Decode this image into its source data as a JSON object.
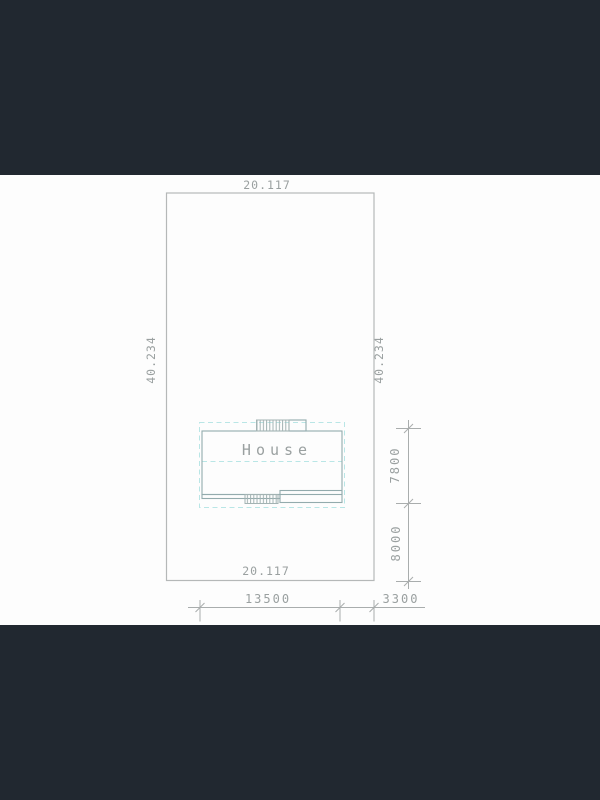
{
  "colors": {
    "band": "#212830",
    "paper": "#fdfdfd",
    "boundary": "#b5b8b8",
    "dims": "#a9adad",
    "house": "#93abad",
    "hatch": "#a3b3b3",
    "dashed": "#b9e6e6",
    "text": "#9aa0a0"
  },
  "plan": {
    "house_label": "House",
    "lot_width_top": "20.117",
    "lot_width_bottom": "20.117",
    "lot_depth_left": "40.234",
    "lot_depth_right": "40.234",
    "dim_house_depth": "7800",
    "dim_house_to_rear": "8000",
    "dim_house_width": "13500",
    "dim_side_offset": "3300"
  }
}
